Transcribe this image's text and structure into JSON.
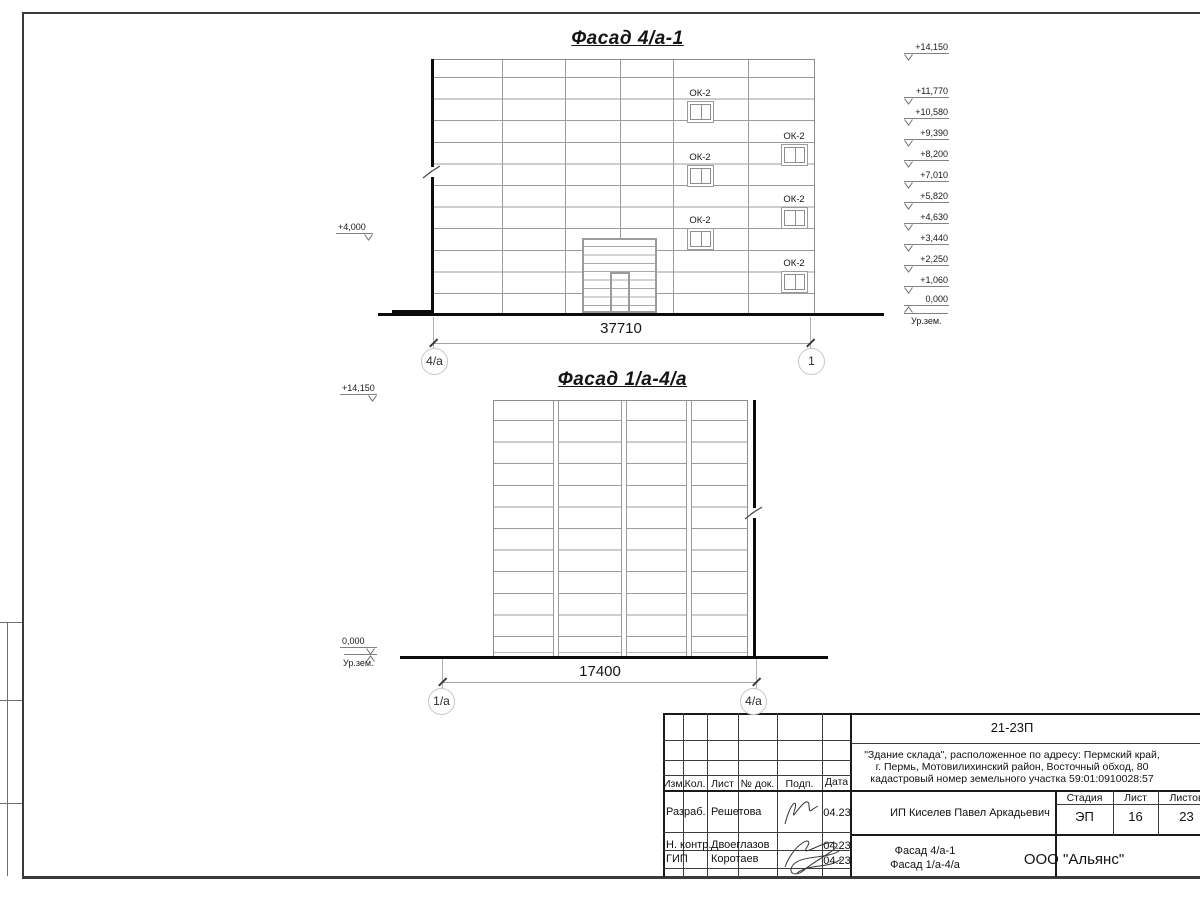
{
  "drawing": {
    "facade1": {
      "title": "Фасад 4/а-1",
      "dimension": "37710",
      "axis_left": "4/а",
      "axis_right": "1",
      "window_label": "ОК-2",
      "elevation_left": "+4,000",
      "elevations": [
        "+14,150",
        "+11,770",
        "+10,580",
        "+9,390",
        "+8,200",
        "+7,010",
        "+5,820",
        "+4,630",
        "+3,440",
        "+2,250",
        "+1,060",
        "0,000"
      ],
      "ground_label": "Ур.зем."
    },
    "facade2": {
      "title": "Фасад 1/а-4/а",
      "dimension": "17400",
      "axis_left": "1/а",
      "axis_right": "4/а",
      "elevation_top": "+14,150",
      "elevation_zero": "0,000",
      "ground_label": "Ур.зем."
    }
  },
  "titleblock": {
    "code": "21-23П",
    "address_lines": [
      "\"Здание склада\", расположенное по адресу: Пермский край,",
      "г. Пермь, Мотовилихинский район, Восточный обход, 80",
      "кадастровый номер земельного участка 59:01:0910028:57"
    ],
    "client": "ИП Киселев Павел Аркадьевич",
    "columns": [
      "Изм.",
      "Кол.",
      "Лист",
      "№ док.",
      "Подп.",
      "Дата"
    ],
    "rows": [
      {
        "role": "Разраб.",
        "name": "Решетова",
        "date": "04.23"
      },
      {
        "role": "Н. контр.",
        "name": "Двоеглазов",
        "date": "04.23"
      },
      {
        "role": "ГИП",
        "name": "Коротаев",
        "date": "04.23"
      }
    ],
    "stage_label": "Стадия",
    "sheet_label": "Лист",
    "sheets_label": "Листов",
    "stage": "ЭП",
    "sheet_number": "16",
    "sheets_total": "23",
    "sheet_title_line1": "Фасад 4/а-1",
    "sheet_title_line2": "Фасад 1/а-4/а",
    "company": "ООО \"Альянс\""
  }
}
